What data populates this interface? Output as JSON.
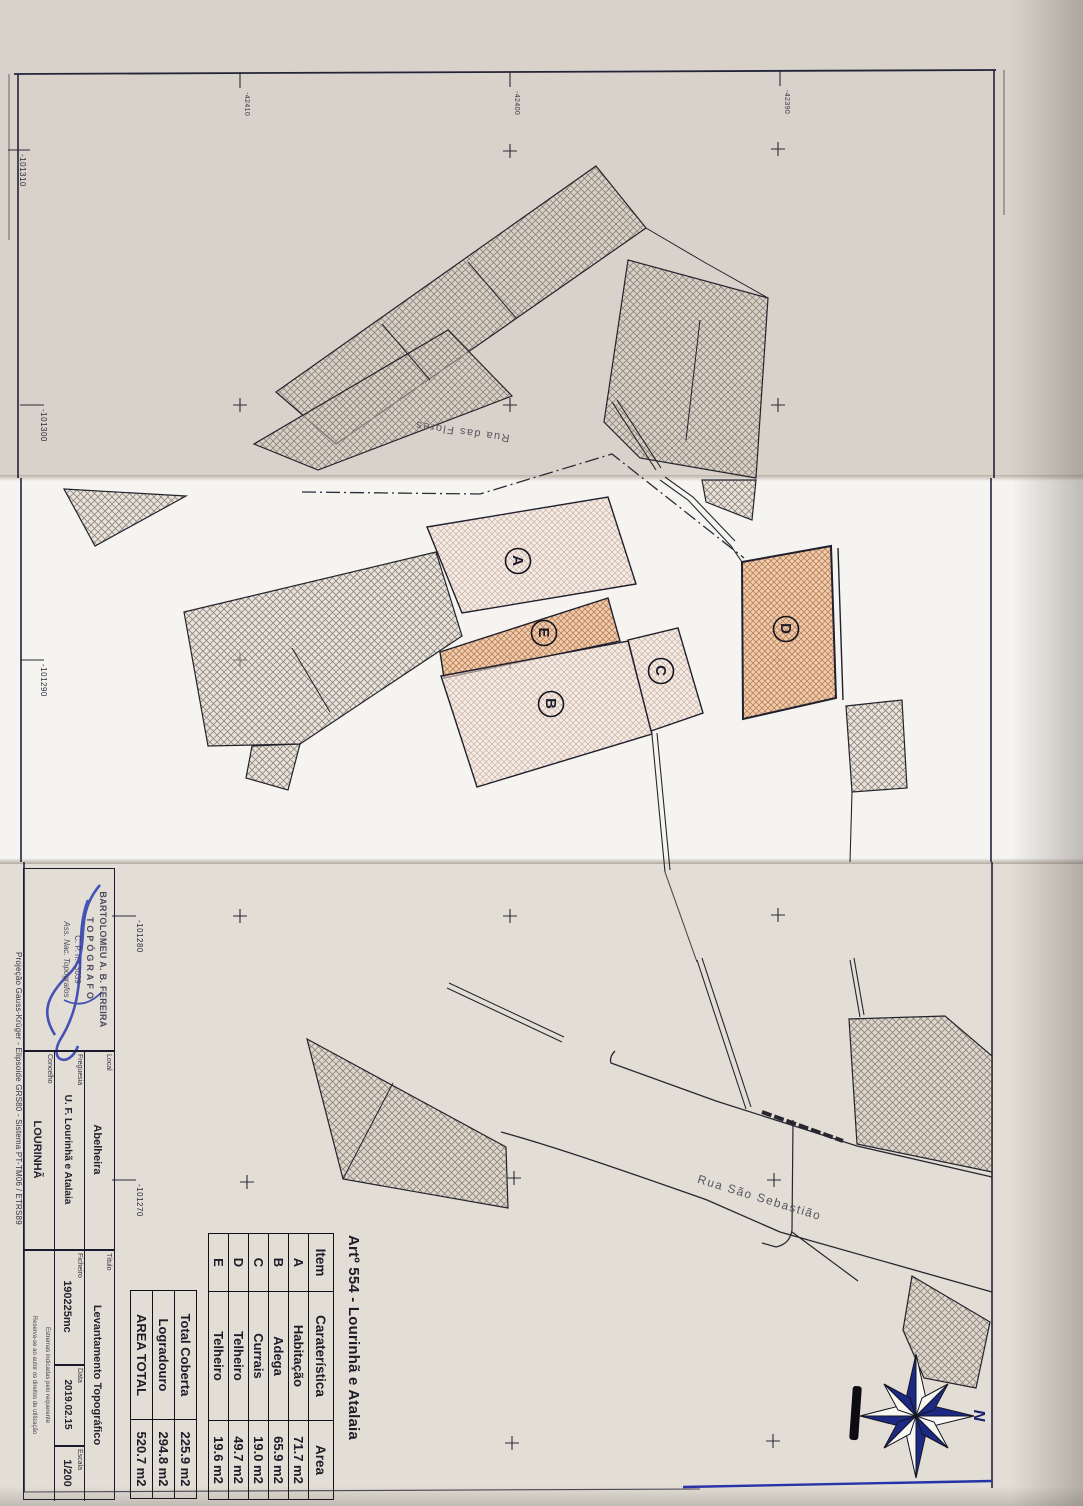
{
  "plan": {
    "title": "Artº 554 - Lourinhã e Atalaia",
    "table": {
      "headers": {
        "item": "Item",
        "feature": "Caraterística",
        "area": "Area"
      },
      "rows": [
        {
          "item": "A",
          "feature": "Habitação",
          "area": "71.7 m2"
        },
        {
          "item": "B",
          "feature": "Adega",
          "area": "65.9 m2"
        },
        {
          "item": "C",
          "feature": "Currais",
          "area": "19.0 m2"
        },
        {
          "item": "D",
          "feature": "Telheiro",
          "area": "49.7 m2"
        },
        {
          "item": "E",
          "feature": "Telheiro",
          "area": "19.6 m2"
        }
      ],
      "totals": [
        {
          "feature": "Total Coberta",
          "area": "225.9 m2"
        },
        {
          "feature": "Logradouro",
          "area": "294.8 m2"
        },
        {
          "feature": "AREA TOTAL",
          "area": "520.7 m2"
        }
      ]
    },
    "markers": {
      "a": "A",
      "b": "B",
      "c": "C",
      "d": "D",
      "e": "E"
    },
    "streets": {
      "street1": "Rua das Flores",
      "street2": "Rua São Sebastião"
    },
    "compass_n": "N",
    "coords": {
      "left": [
        "-101310",
        "-101300",
        "-101290",
        "-101280",
        "-101270"
      ],
      "top": [
        "-42410",
        "-42400",
        "-42390"
      ]
    }
  },
  "title_block": {
    "stamp": {
      "line1": "BARTOLOMEU A. B. FEREIRA",
      "line2": "TOPÓGRAFO",
      "line3": "C. P. n.º 3039",
      "line4": "Ass. Nac. Topógrafos"
    },
    "fields": {
      "local_label": "Local",
      "local": "Abelheira",
      "freguesia_label": "Freguesia",
      "freguesia": "U. F. Lourinhã e Atalaia",
      "concelho_label": "Concelho",
      "concelho": "LOURINHÃ",
      "titulo_label": "Título",
      "titulo": "Levantamento Topográfico",
      "ficheiro_label": "Ficheiro",
      "ficheiro": "190225mc",
      "data_label": "Data",
      "data": "2019.02.15",
      "escala_label": "Escala",
      "escala": "1/200",
      "note1": "Estremas indicadas pelo requerente",
      "note2": "Reserva-se ao autor os direitos de utilização"
    },
    "projection": "Projeção Gauss-Krüger - Elipsoide GRS80 - Sistema PT-TM06 / ETRS89"
  }
}
